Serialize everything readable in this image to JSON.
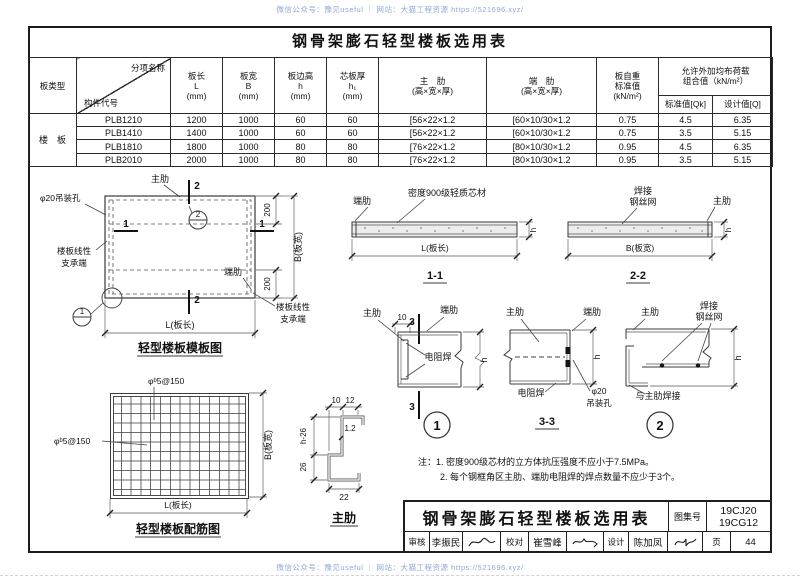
{
  "watermark": {
    "text": "微信公众号：豫见useful ｜ 网站：大猫工程资源 https://521696.xyz/"
  },
  "page": {
    "title": "钢骨架膨石轻型楼板选用表"
  },
  "table": {
    "headers": {
      "board_type": "板类型",
      "diag_top": "分项名称",
      "diag_bottom": "构件代号",
      "len": [
        "板长",
        "L",
        "(mm)"
      ],
      "width": [
        "板宽",
        "B",
        "(mm)"
      ],
      "edge_height": [
        "板边高",
        "h",
        "(mm)"
      ],
      "core_thickness": [
        "芯板厚",
        "h₁",
        "(mm)"
      ],
      "main_rib": [
        "主　肋",
        "(高×宽×厚)"
      ],
      "end_rib": [
        "端　肋",
        "(高×宽×厚)"
      ],
      "self_weight": [
        "板自重",
        "标准值",
        "(kN/m²)"
      ],
      "allow_load": [
        "允许外加均布荷载",
        "组合值（kN/m²）"
      ],
      "std_value": "标准值[Qk]",
      "design_value": "设计值[Q]"
    },
    "row_group": "楼　板",
    "rows": [
      {
        "code": "PLB1210",
        "L": "1200",
        "B": "1000",
        "h": "60",
        "h1": "60",
        "main_rib": "[56×22×1.2",
        "end_rib": "[60×10/30×1.2",
        "weight": "0.75",
        "qk": "4.5",
        "q": "6.35"
      },
      {
        "code": "PLB1410",
        "L": "1400",
        "B": "1000",
        "h": "60",
        "h1": "60",
        "main_rib": "[56×22×1.2",
        "end_rib": "[60×10/30×1.2",
        "weight": "0.75",
        "qk": "3.5",
        "q": "5.15"
      },
      {
        "code": "PLB1810",
        "L": "1800",
        "B": "1000",
        "h": "80",
        "h1": "80",
        "main_rib": "[76×22×1.2",
        "end_rib": "[80×10/30×1.2",
        "weight": "0.95",
        "qk": "4.5",
        "q": "6.35"
      },
      {
        "code": "PLB2010",
        "L": "2000",
        "B": "1000",
        "h": "80",
        "h1": "80",
        "main_rib": "[76×22×1.2",
        "end_rib": "[80×10/30×1.2",
        "weight": "0.95",
        "qk": "3.5",
        "q": "5.15"
      }
    ]
  },
  "diagrams": {
    "plan": {
      "caption": "轻型楼板模板图",
      "main_rib": "主肋",
      "end_rib": "端肋",
      "lifting_hole": "φ20吊装孔",
      "support_line1": "楼板线性",
      "support_line2": "支承端",
      "mark1": "1",
      "mark2": "2",
      "dim200": "200",
      "dimB": "B(板宽)",
      "dimL": "L(板长)"
    },
    "section11": {
      "caption": "1-1",
      "end_rib": "端肋",
      "core": "密度900级轻质芯材",
      "dimL": "L(板长)",
      "dimh": "h"
    },
    "section22": {
      "caption": "2-2",
      "weld1": "焊接",
      "weld2": "钢丝网",
      "main_rib": "主肋",
      "dimB": "B(板宽)",
      "dimh": "h"
    },
    "detail1": {
      "num": "1",
      "main_rib": "主肋",
      "end_rib": "端肋",
      "weld": "电阻焊",
      "dim10": "10",
      "mark3": "3",
      "dimh": "h"
    },
    "section33": {
      "caption": "3-3",
      "main_rib": "主肋",
      "end_rib": "端肋",
      "weld": "电阻焊",
      "hole1": "φ20",
      "hole2": "吊装孔",
      "dimh": "h"
    },
    "detail2": {
      "num": "2",
      "main_rib": "主肋",
      "weld1": "焊接",
      "weld2": "钢丝网",
      "weld_note": "与主肋焊接",
      "dimh": "h"
    },
    "rebar": {
      "caption": "轻型楼板配筋图",
      "mesh": "φᵇ5@150",
      "dimL": "L(板长)",
      "dimB": "B(板宽)"
    },
    "rib_profile": {
      "caption": "主肋",
      "dim10": "10",
      "dim12": "12",
      "thick": "1.2",
      "dimh26": "h-26",
      "dim26": "26",
      "dim22": "22"
    }
  },
  "notes": {
    "line1": "注：1. 密度900级芯材的立方体抗压强度不应小于7.5MPa。",
    "line2": "2. 每个钢框角区主肋、端肋电阻焊的焊点数量不应少于3个。"
  },
  "title_block": {
    "title": "钢骨架膨石轻型楼板选用表",
    "atlas_label": "图集号",
    "atlas_no_1": "19CJ20",
    "atlas_no_2": "19CG12",
    "review_label": "审核",
    "reviewer": "李振民",
    "check_label": "校对",
    "checker": "崔雪峰",
    "design_label": "设计",
    "designer": "陈加凤",
    "page_label": "页",
    "page_no": "44"
  }
}
